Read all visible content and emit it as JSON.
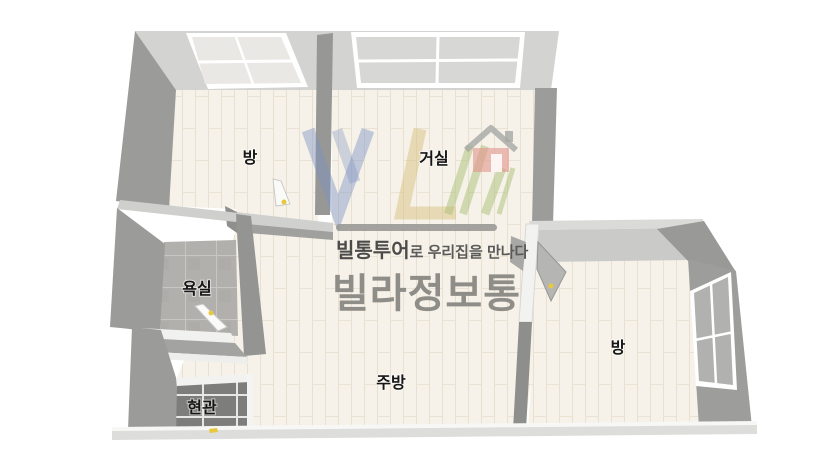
{
  "rooms": {
    "room_top_left": "방",
    "living_room": "거실",
    "bathroom": "욕실",
    "entrance": "현관",
    "kitchen": "주방",
    "room_right": "방"
  },
  "watermark": {
    "tagline_brand": "빌통투어",
    "tagline_rest": "로 우리집을 만나다",
    "brand_large": "빌라정보통",
    "logo_letters": "VL",
    "colors": {
      "logo_blue": "#7d93c4",
      "logo_yellow": "#d6c07e",
      "logo_green": "#acc076",
      "logo_house_red": "#e2948e",
      "tagline_color": "#4b4b49",
      "brand_color": "#8f8d87"
    }
  },
  "palette": {
    "background": "#ffffff",
    "wall_dark": "#9b9b99",
    "wall_light": "#d3d3d1",
    "floor_wood": "#f6f2e9",
    "bathroom_tile": "#b2b0ac",
    "entrance_tile": "#7d7d7b",
    "window_frame": "#ffffff",
    "door_handle_yellow": "#e9c83d"
  }
}
